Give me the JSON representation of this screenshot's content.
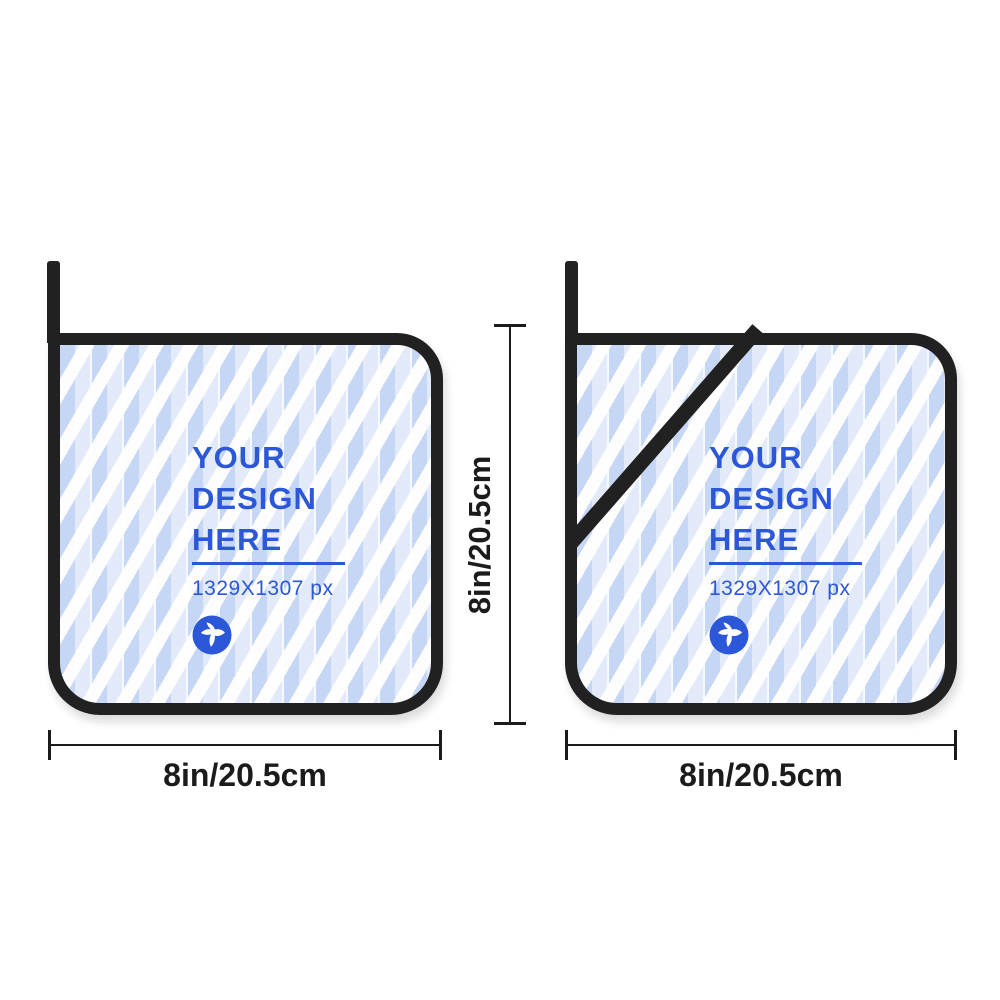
{
  "design_placeholder": {
    "line1": "YOUR",
    "line2": "DESIGN",
    "line3": "HERE",
    "size_note": "1329X1307 px"
  },
  "dimensions": {
    "height_label": "8in/20.5cm",
    "width_label_left": "8in/20.5cm",
    "width_label_right": "8in/20.5cm"
  },
  "icons": {
    "logo": "hummingbird-logo-icon"
  },
  "colors": {
    "design_text_blue": "#2b57d8",
    "stripe_blue": "#c6d6f5",
    "stripe_white": "#fdfdfe",
    "binding_black": "#212121",
    "dimension_black": "#1b1b1b",
    "background_white": "#ffffff"
  }
}
